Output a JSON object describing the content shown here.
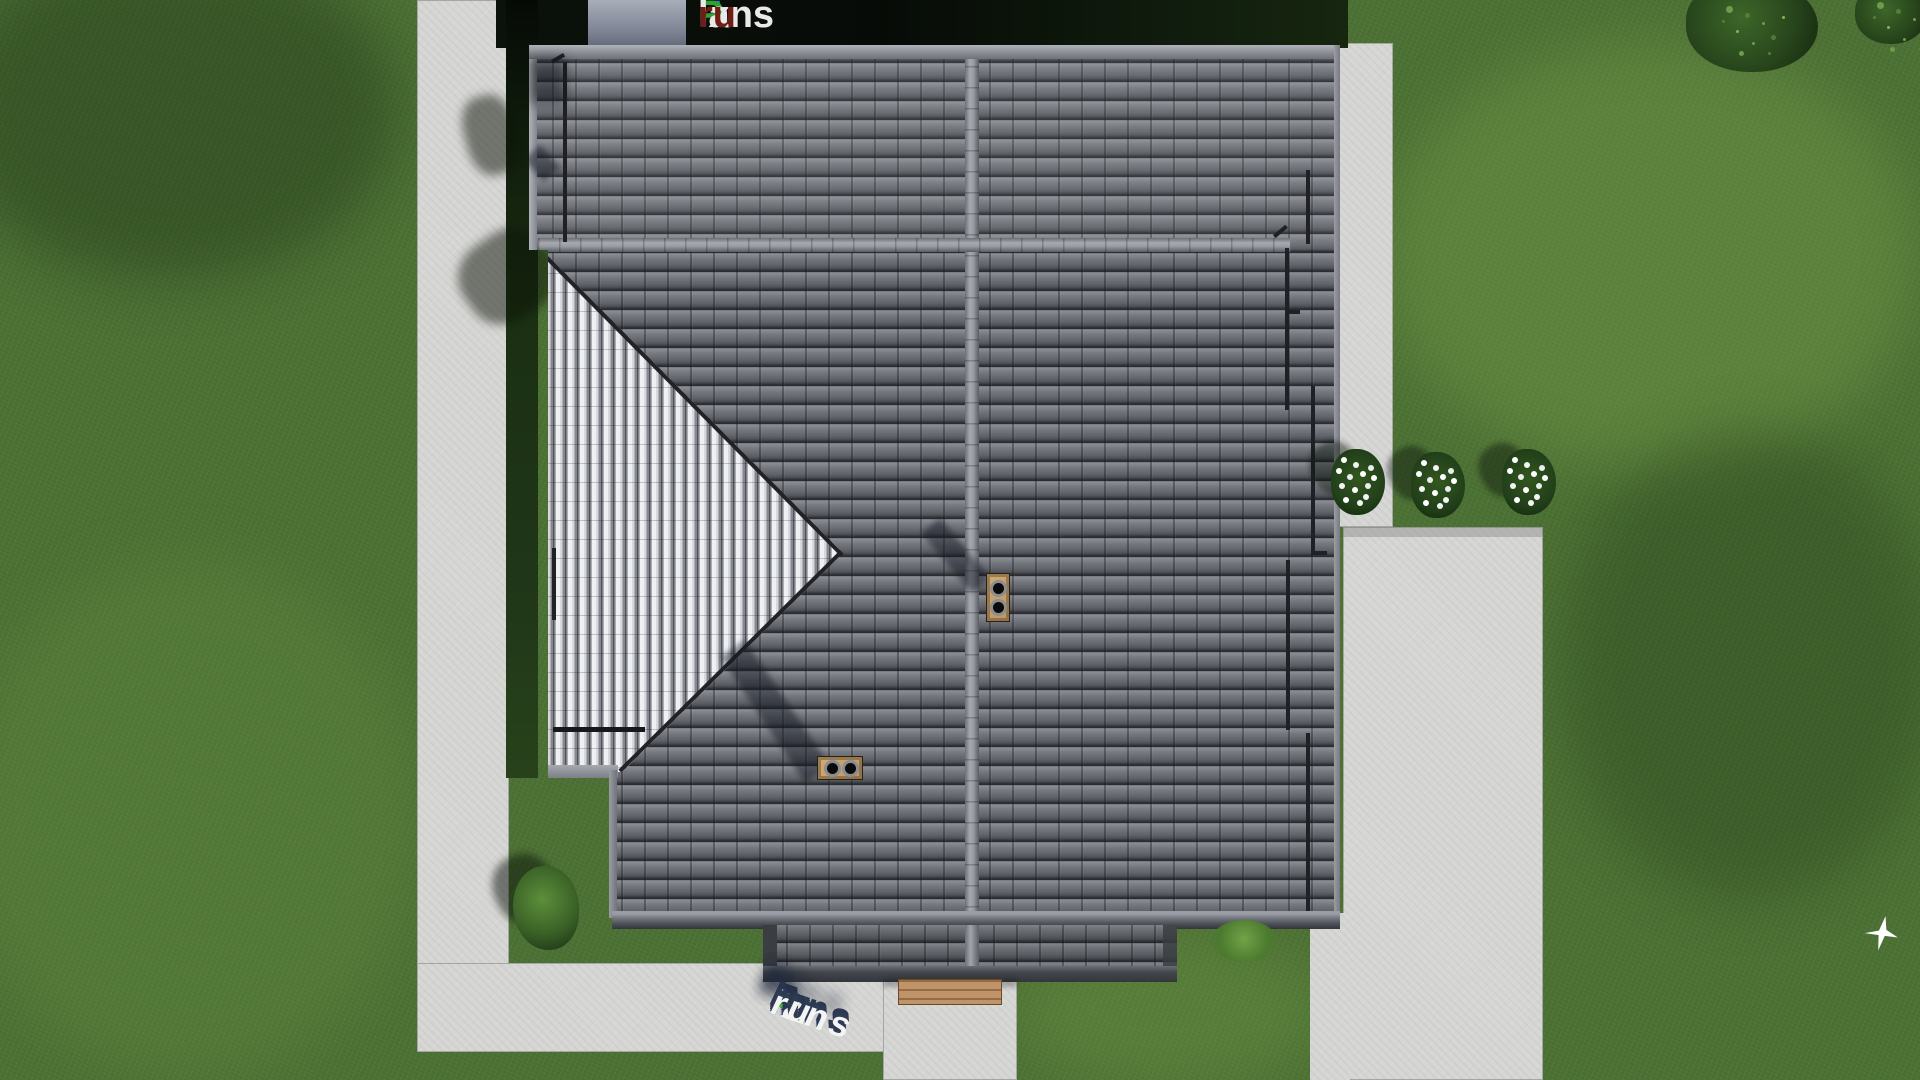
{
  "brand": "FixPlans.ru",
  "watermark_top": {
    "text": "FixPlans.ru",
    "segments": [
      {
        "text": "F",
        "color": "#2e6fd8"
      },
      {
        "text": "ix",
        "color": "#e9e9e9"
      },
      {
        "text": "P",
        "color": "#2ea32c"
      },
      {
        "text": "lans",
        "color": "#e9e9e9"
      },
      {
        "text": ".",
        "color": "#2e6fd8"
      },
      {
        "text": "ru",
        "color": "#6f1d15"
      }
    ]
  },
  "watermark_ground": {
    "text": "FixPlans.ru",
    "style": "3d-extruded",
    "segments": [
      {
        "text": "F",
        "color": "#28a7e6"
      },
      {
        "text": "ix",
        "color": "#f4f4f4"
      },
      {
        "text": "P",
        "color": "#4ac32f"
      },
      {
        "text": "lans",
        "color": "#f4f4f4"
      },
      {
        "text": ".",
        "color": "#28a7e6"
      },
      {
        "text": "ru",
        "color": "#f4f4f4"
      }
    ]
  },
  "palette": {
    "grass": "#4c7134",
    "grass_light": "#6f9c4a",
    "pavement": "#d6d6d4",
    "roof_tile": "#6b6e75",
    "roof_tile_dark": "#2a2c31",
    "roof_bright_face": "#eff0f3",
    "ridge": "#9b9ea5",
    "chimney_tan": "#c8a06a",
    "hedge_dark": "#0b110b",
    "logo_shadow_navy": "#2e3c55"
  },
  "scene": {
    "objects": [
      "house-roof-top-view",
      "hip-roof-bright-face",
      "roof-ridge-vertical",
      "roof-ridge-horizontal",
      "chimney-1",
      "chimney-2",
      "porch-roof",
      "doormat",
      "path-left",
      "path-bottom",
      "entry-walk",
      "right-apron",
      "driveway-pad",
      "hedge-top",
      "hedge-left",
      "concrete-block",
      "flower-bush-1",
      "flower-bush-2",
      "flower-bush-3",
      "tree-1",
      "tree-2",
      "garden-bush",
      "corner-bush",
      "white-bird"
    ]
  }
}
